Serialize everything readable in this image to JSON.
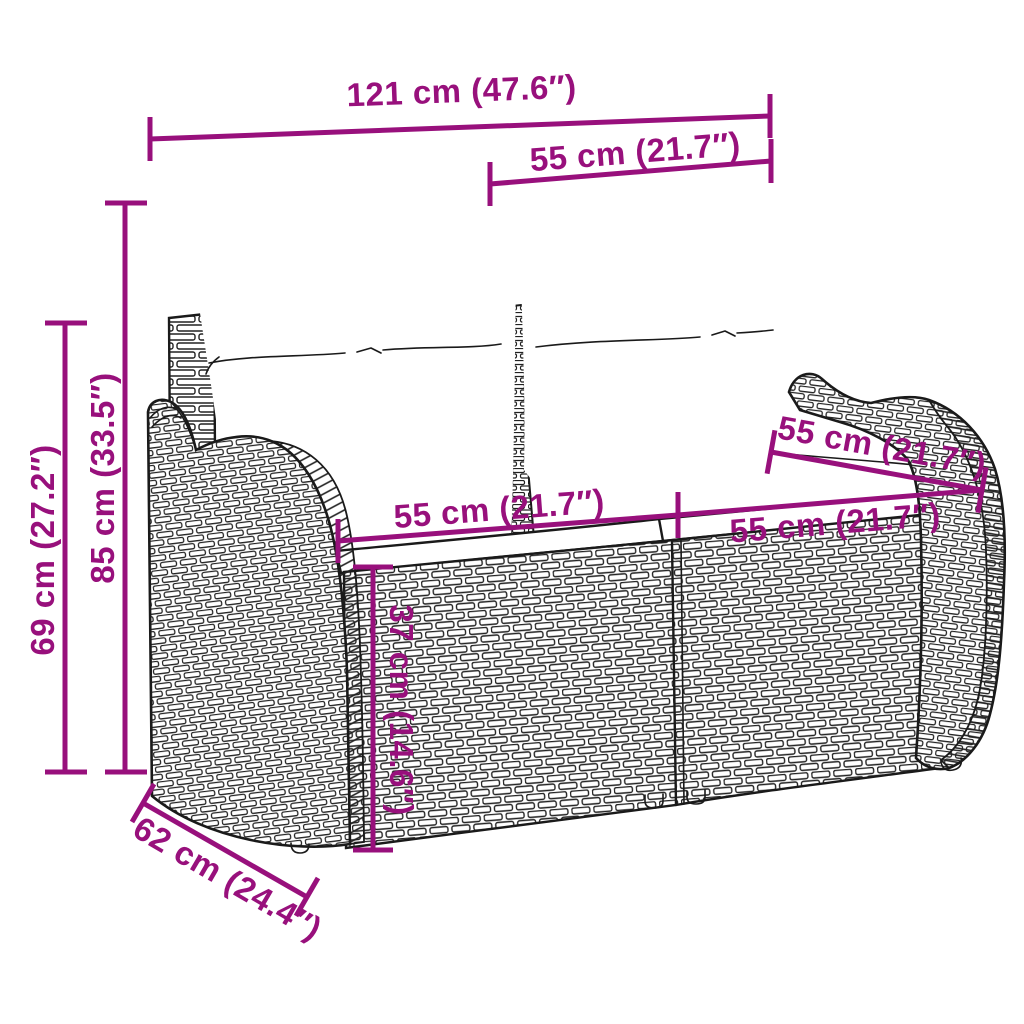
{
  "diagram": {
    "subject": "rattan garden bench with cushions - dimension drawing",
    "colors": {
      "accent": "#98107C",
      "line_art": "#1A1A1A",
      "background": "#FFFFFF"
    },
    "dims": {
      "total_width": "121 cm (47.6″)",
      "back_cushion_width": "55 cm (21.7″)",
      "total_height": "85 cm (33.5″)",
      "armrest_height": "69 cm (27.2″)",
      "seat_depth": "55 cm (21.7″)",
      "seat_width_left": "55 cm (21.7″)",
      "seat_width_right": "55 cm (21.7″)",
      "seat_height": "37 cm (14.6″)",
      "total_depth": "62 cm (24.4″)"
    }
  }
}
